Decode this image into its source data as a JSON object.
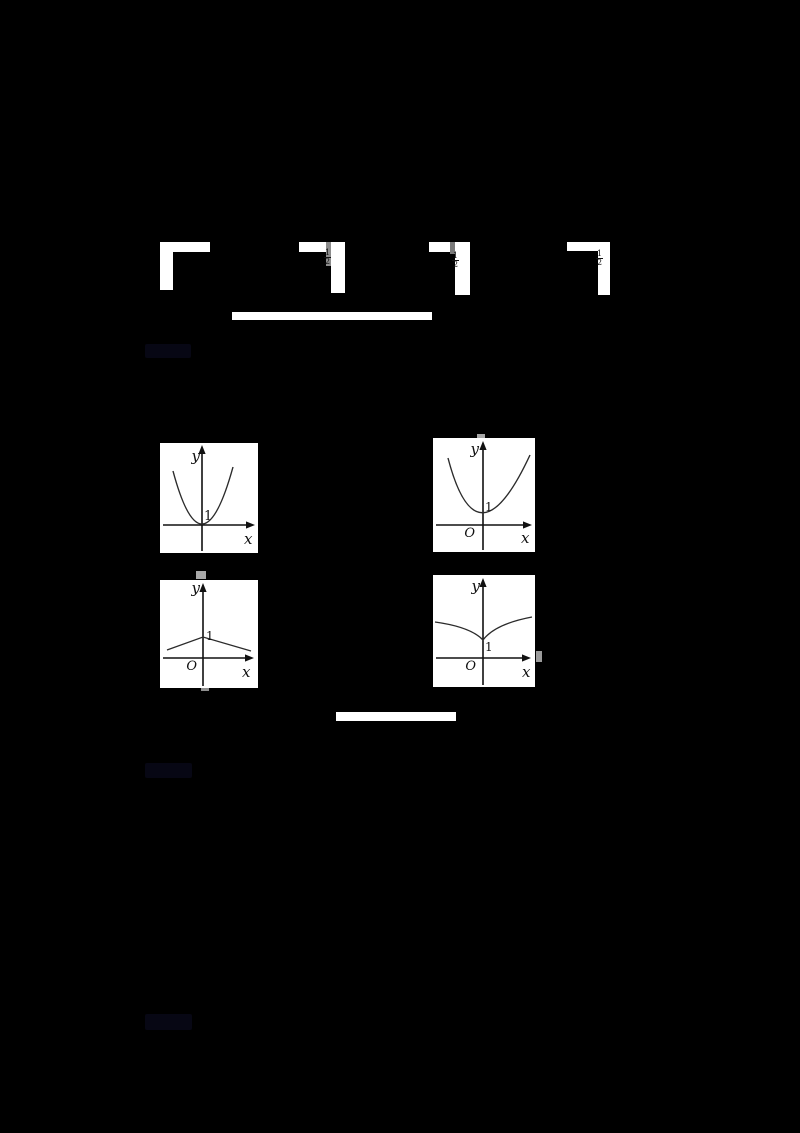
{
  "canvas": {
    "bg": "#000000",
    "width": 800,
    "height": 1133
  },
  "colors": {
    "background": "#000000",
    "figure_background": "#ffffff",
    "axis": "#111111",
    "curve": "#2b2b2b",
    "redacted_blob": "#070714",
    "fraction_text": "#111111",
    "smudge_gray": "#a0a0a0"
  },
  "fragments": {
    "note": "four partially-visible white formula/answer-box corner fragments in a row",
    "f2": {
      "fraction": {
        "num": "1",
        "den": "2"
      }
    },
    "f3": {
      "fraction": {
        "num": "1",
        "den": "2"
      }
    },
    "f4": {
      "fraction": {
        "num": "1",
        "den": "2"
      }
    }
  },
  "graphs": [
    {
      "id": "A",
      "labels": {
        "y": "y",
        "x": "x",
        "origin": "",
        "value": "1"
      }
    },
    {
      "id": "B",
      "labels": {
        "y": "y",
        "x": "x",
        "origin": "O",
        "value": "1"
      }
    },
    {
      "id": "C",
      "labels": {
        "y": "y",
        "x": "x",
        "origin": "O",
        "value": "1"
      }
    },
    {
      "id": "D",
      "labels": {
        "y": "y",
        "x": "x",
        "origin": "O",
        "value": "1"
      }
    }
  ],
  "chart_data": [
    {
      "type": "line",
      "title": "Option graph A: upward parabola, vertex at origin",
      "xlabel": "x",
      "ylabel": "y",
      "annotations": [
        "1"
      ],
      "x": [
        -2,
        -1.5,
        -1,
        -0.5,
        0,
        0.5,
        1,
        1.5,
        2
      ],
      "values": [
        4,
        2.25,
        1,
        0.25,
        0,
        0.25,
        1,
        2.25,
        4
      ],
      "xlim": [
        -2.5,
        3
      ],
      "ylim": [
        -1.5,
        4.5
      ],
      "grid": false
    },
    {
      "type": "line",
      "title": "Option graph B: upward parabola, vertex at (0,1)",
      "xlabel": "x",
      "ylabel": "y",
      "annotations": [
        "1",
        "O"
      ],
      "x": [
        -2,
        -1.5,
        -1,
        -0.5,
        0,
        0.5,
        1,
        1.5,
        2
      ],
      "values": [
        5,
        3.25,
        2,
        1.25,
        1,
        1.25,
        2,
        3.25,
        5
      ],
      "xlim": [
        -2.5,
        3
      ],
      "ylim": [
        -1.5,
        5.5
      ],
      "grid": false
    },
    {
      "type": "line",
      "title": "Option graph C: tent / inverted-V peak at (0,1)",
      "xlabel": "x",
      "ylabel": "y",
      "annotations": [
        "1",
        "O"
      ],
      "x": [
        -3,
        -2,
        -1,
        0,
        1,
        2,
        3
      ],
      "values": [
        0.35,
        0.55,
        0.8,
        1,
        0.8,
        0.55,
        0.35
      ],
      "xlim": [
        -3.5,
        4
      ],
      "ylim": [
        -1.5,
        4
      ],
      "grid": false
    },
    {
      "type": "line",
      "title": "Option graph D: curved V (cusp) with minimum at (0,1)",
      "xlabel": "x",
      "ylabel": "y",
      "annotations": [
        "1",
        "O"
      ],
      "x": [
        -3,
        -2,
        -1,
        0,
        1,
        2,
        3
      ],
      "values": [
        2.75,
        2.4,
        2,
        1,
        2,
        2.4,
        2.75
      ],
      "xlim": [
        -3.5,
        4
      ],
      "ylim": [
        -1.5,
        4
      ],
      "grid": false
    }
  ],
  "bars": {
    "divider1": "",
    "divider2": ""
  },
  "redacted_blobs": {
    "count": 3,
    "appearance": "very dark navy unreadable text blobs"
  }
}
